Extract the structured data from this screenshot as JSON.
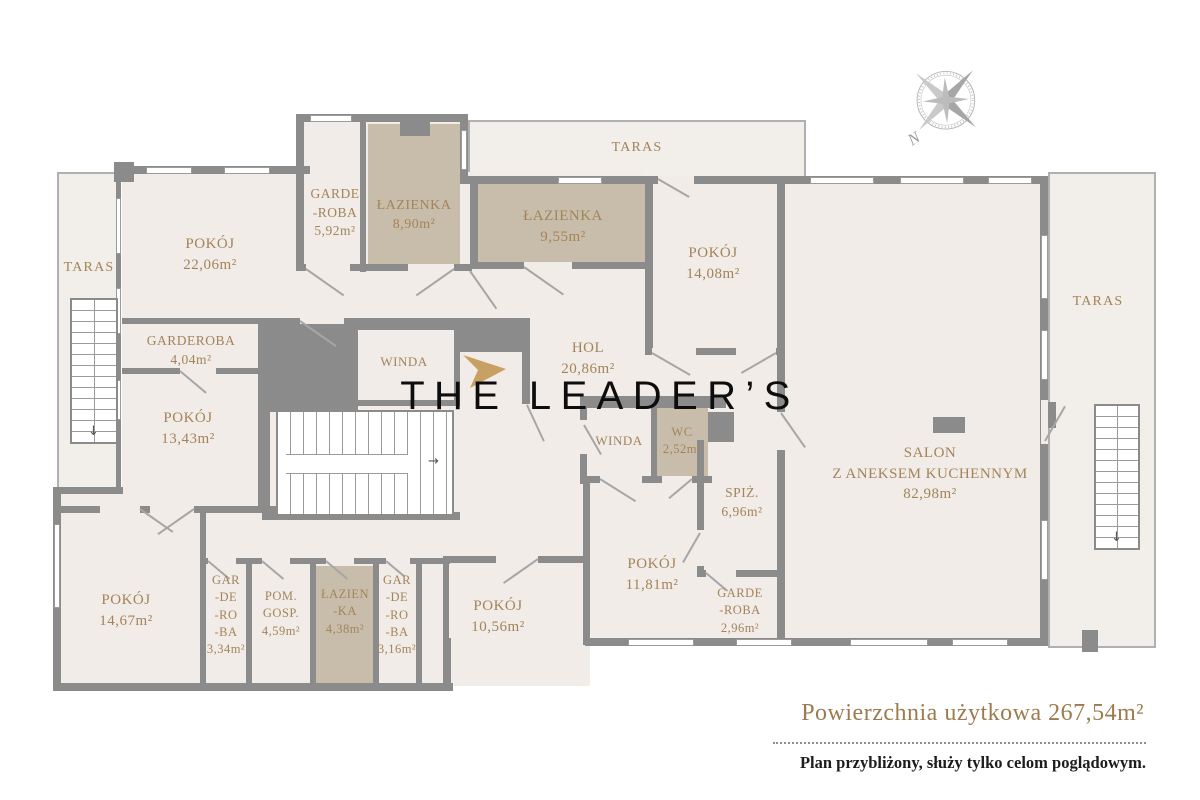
{
  "logo": {
    "text": "THE LEADER’S"
  },
  "compass": {
    "north": "N"
  },
  "icons": {
    "stairs_arrow_down": "↓",
    "stairs_arrow_right": "→"
  },
  "colors": {
    "wall": "#8b8b8b",
    "floor": "#f1ece7",
    "wet_room_fill": "#c8bdab",
    "room_label": "#a3845a",
    "accent_gold": "#c9a063",
    "footer_gold": "#9c7c4e"
  },
  "rooms": {
    "taras_left": {
      "name": "TARAS",
      "area": ""
    },
    "pokoj_2206": {
      "name": "POKÓJ",
      "area": "22,06m²"
    },
    "garderoba_592": {
      "name": "GARDE\n-ROBA",
      "area": "5,92m²"
    },
    "lazienka_890": {
      "name": "ŁAZIENKA",
      "area": "8,90m²"
    },
    "taras_top": {
      "name": "TARAS",
      "area": ""
    },
    "lazienka_955": {
      "name": "ŁAZIENKA",
      "area": "9,55m²"
    },
    "pokoj_1408": {
      "name": "POKÓJ",
      "area": "14,08m²"
    },
    "taras_right": {
      "name": "TARAS",
      "area": ""
    },
    "garderoba_404": {
      "name": "GARDEROBA",
      "area": "4,04m²"
    },
    "winda_left": {
      "name": "WINDA",
      "area": ""
    },
    "pokoj_1343": {
      "name": "POKÓJ",
      "area": "13,43m²"
    },
    "hol": {
      "name": "HOL",
      "area": "20,86m²"
    },
    "winda_center": {
      "name": "WINDA",
      "area": ""
    },
    "wc": {
      "name": "WC",
      "area": "2,52m²"
    },
    "spiz": {
      "name": "SPIŻ.",
      "area": "6,96m²"
    },
    "salon": {
      "name": "SALON\nZ ANEKSEM KUCHENNYM",
      "area": "82,98m²"
    },
    "pokoj_1467": {
      "name": "POKÓJ",
      "area": "14,67m²"
    },
    "gar_334": {
      "name": "GAR\n-DE\n-RO\n-BA",
      "area": "3,34m²"
    },
    "pom_gosp": {
      "name": "POM.\nGOSP.",
      "area": "4,59m²"
    },
    "lazienka_438": {
      "name": "ŁAZIEN\n-KA",
      "area": "4,38m²"
    },
    "gar_316": {
      "name": "GAR\n-DE\n-RO\n-BA",
      "area": "3,16m²"
    },
    "pokoj_1056": {
      "name": "POKÓJ",
      "area": "10,56m²"
    },
    "pokoj_1181": {
      "name": "POKÓJ",
      "area": "11,81m²"
    },
    "garderoba_296": {
      "name": "GARDE\n-ROBA",
      "area": "2,96m²"
    }
  },
  "footer": {
    "total_area": "Powierzchnia użytkowa 267,54m²",
    "disclaimer": "Plan przybliżony, służy tylko celom poglądowym."
  }
}
